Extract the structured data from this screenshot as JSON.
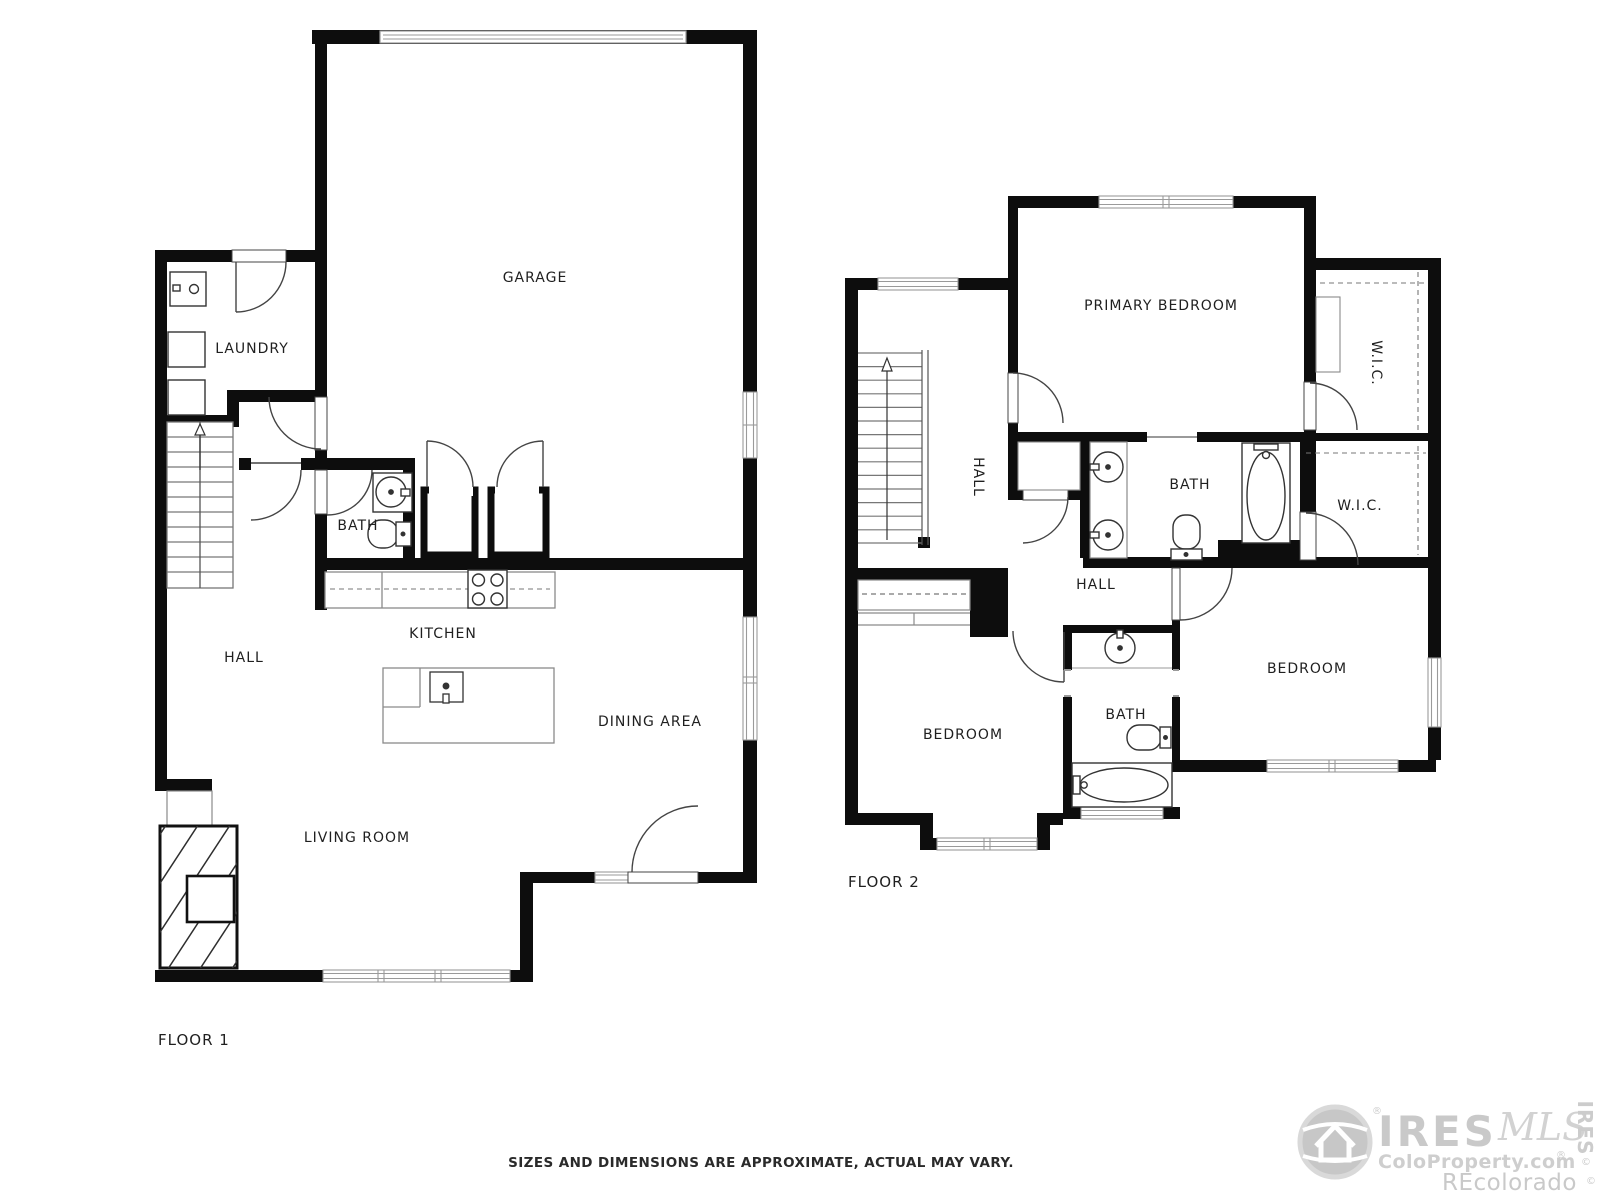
{
  "colors": {
    "wall": "#0d0d0d",
    "fixture_line": "#3a3a3a",
    "window_line": "#9a9a9a",
    "dashed_line": "#777777",
    "label_text": "#1f1f1f",
    "watermark": "#c9c9c9"
  },
  "floor1": {
    "title": "FLOOR 1",
    "rooms": {
      "garage": "GARAGE",
      "laundry": "LAUNDRY",
      "bath": "BATH",
      "kitchen": "KITCHEN",
      "hall": "HALL",
      "dining": "DINING AREA",
      "living": "LIVING ROOM"
    }
  },
  "floor2": {
    "title": "FLOOR 2",
    "rooms": {
      "primary": "PRIMARY BEDROOM",
      "hall_upper": "HALL",
      "bath_primary": "BATH",
      "wic_upper": "W.I.C.",
      "wic_lower": "W.I.C.",
      "hall_lower": "HALL",
      "bedroom_left": "BEDROOM",
      "bath_small": "BATH",
      "bedroom_right": "BEDROOM"
    }
  },
  "disclaimer": "SIZES AND DIMENSIONS ARE APPROXIMATE, ACTUAL MAY VARY.",
  "watermark": {
    "brand": "IRES",
    "mls": "MLS",
    "site": "ColoProperty.com",
    "reg": "®",
    "copy": "©",
    "recolorado": "REcolorado",
    "side_brand": "IRES"
  }
}
